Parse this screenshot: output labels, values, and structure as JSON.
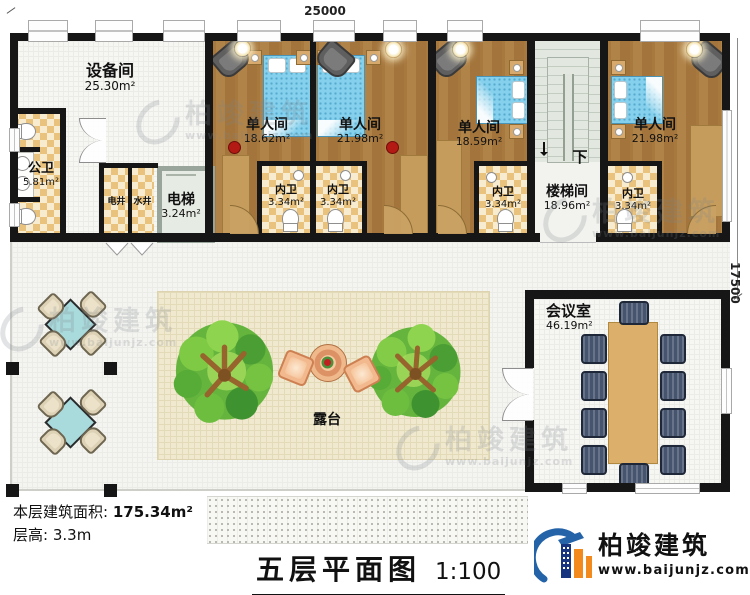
{
  "title": {
    "text": "五层平面图",
    "scale": "1:100"
  },
  "dimensions": {
    "width": "25000",
    "height": "17500"
  },
  "info": {
    "floor_area_label": "本层建筑面积:",
    "floor_area_value": "175.34m²",
    "floor_height_label": "层高:",
    "floor_height_value": "3.3m"
  },
  "rooms": {
    "equipment": {
      "name": "设备间",
      "area": "25.30m²"
    },
    "public_wc": {
      "name": "公卫",
      "area": "5.81m²"
    },
    "elec_shaft": {
      "name": "电井"
    },
    "water_shaft": {
      "name": "水井"
    },
    "elevator": {
      "name": "电梯",
      "area": "3.24m²"
    },
    "bedroom1": {
      "name": "单人间",
      "area": "18.62m²"
    },
    "bedroom2": {
      "name": "单人间",
      "area": "21.98m²"
    },
    "bedroom3": {
      "name": "单人间",
      "area": "18.59m²"
    },
    "bedroom4": {
      "name": "单人间",
      "area": "21.98m²"
    },
    "ensuites": [
      {
        "name": "内卫",
        "area": "3.34m²"
      },
      {
        "name": "内卫",
        "area": "3.34m²"
      },
      {
        "name": "内卫",
        "area": "3.34m²"
      },
      {
        "name": "内卫",
        "area": "3.34m²"
      }
    ],
    "stairwell": {
      "name": "楼梯间",
      "area": "18.96m²",
      "direction": "下"
    },
    "terrace": {
      "name": "露台"
    },
    "meeting": {
      "name": "会议室",
      "area": "46.19m²"
    }
  },
  "branding": {
    "name": "柏竣建筑",
    "website": "www.baijunjz.com"
  },
  "colors": {
    "wall": "#161616",
    "wood_floor": "#a8793f",
    "checker_tile": "#e9c27d",
    "bed_blue": "#85d0ec",
    "logo_blue": "#2463a8",
    "logo_orange": "#f28a1e"
  }
}
